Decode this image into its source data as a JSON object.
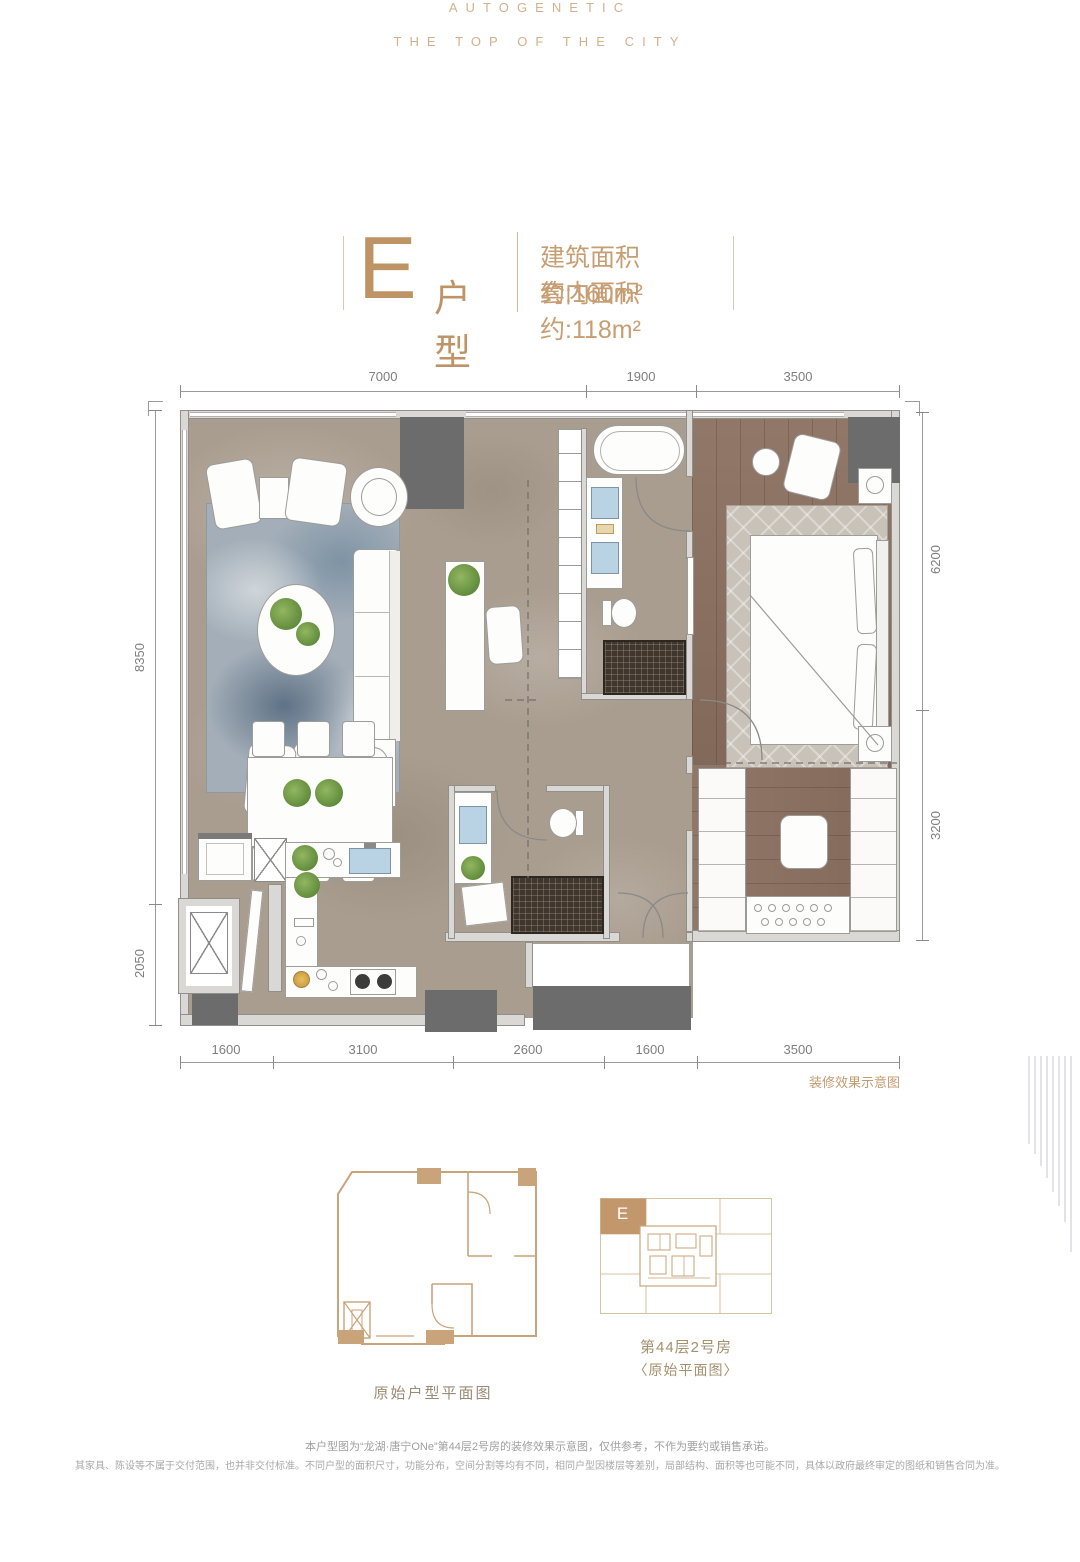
{
  "brand": {
    "line1": "AUTOGENETIC",
    "line2": "THE TOP OF THE CITY"
  },
  "title": {
    "unit": "E",
    "unit_label": "户型",
    "area_line1": "建筑面积约:160m²",
    "area_line2": "套内面积约:118m²"
  },
  "dims": {
    "top": [
      "7000",
      "1900",
      "3500"
    ],
    "bottom": [
      "1600",
      "3100",
      "2600",
      "1600",
      "3500"
    ],
    "left": [
      "8350",
      "2050"
    ],
    "right": [
      "6200",
      "3200"
    ]
  },
  "plan": {
    "render_note": "装修效果示意图"
  },
  "original_plan": {
    "label": "原始户型平面图"
  },
  "key_plan": {
    "unit": "E",
    "room": "第44层2号房",
    "sub": "〈原始平面图〉"
  },
  "disclaimer": {
    "line1": "本户型图为“龙湖·唐宁ONe”第44层2号房的装修效果示意图，仅供参考，不作为要约或销售承诺。",
    "line2": "其家具、陈设等不属于交付范围，也并非交付标准。不同户型的面积尺寸，功能分布，空间分割等均有不同，相同户型因楼层等差别，局部结构、面积等也可能不同，具体以政府最终审定的图纸和销售合同为准。"
  },
  "colors": {
    "gold": "#BE9467",
    "tan_outline": "#C9A379",
    "label_brown": "#9C8A74",
    "dim_gray": "#8A8A8A",
    "marble": "#A99D8F",
    "wood": "#8A6F5E",
    "column_dark": "#6C6C6C"
  }
}
